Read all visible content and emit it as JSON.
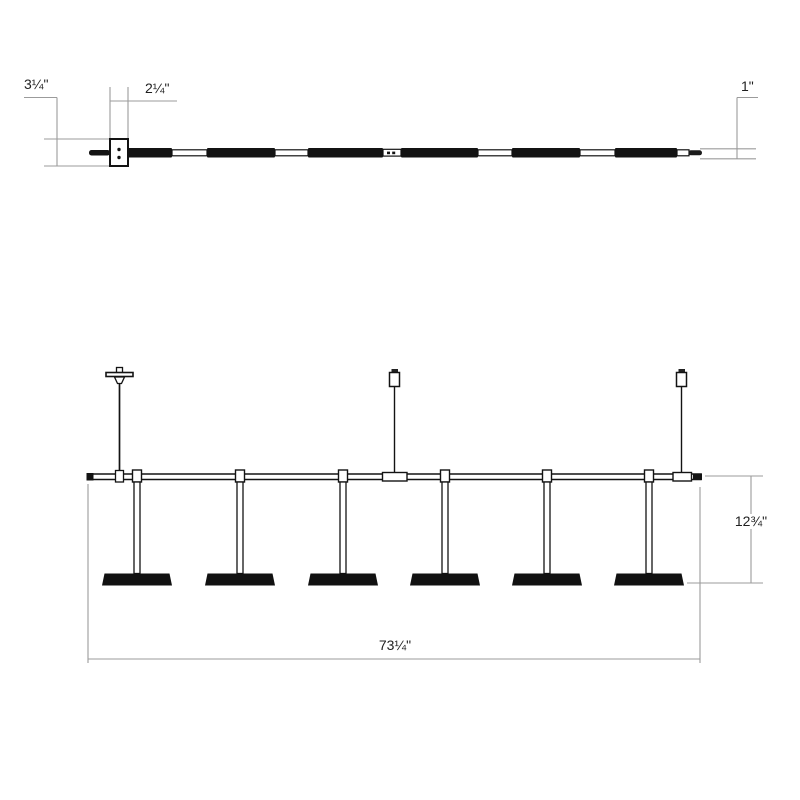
{
  "drawing": {
    "kind": "technical-dimension-drawing",
    "subject": "linear suspension light fixture",
    "colors": {
      "fixture_line": "#131313",
      "dimension_line": "#9b9b9b",
      "label_text": "#1f1f1f",
      "background": "#ffffff"
    },
    "plan_view": {
      "canopy_depth_label": "3¼\"",
      "canopy_width_label": "2¼\"",
      "bar_diameter_label": "1\""
    },
    "elevation_view": {
      "light_bar_count": 6,
      "suspension_point_count": 3,
      "fixture_height_label": "12¾\"",
      "overall_length_label": "73¼\""
    }
  }
}
